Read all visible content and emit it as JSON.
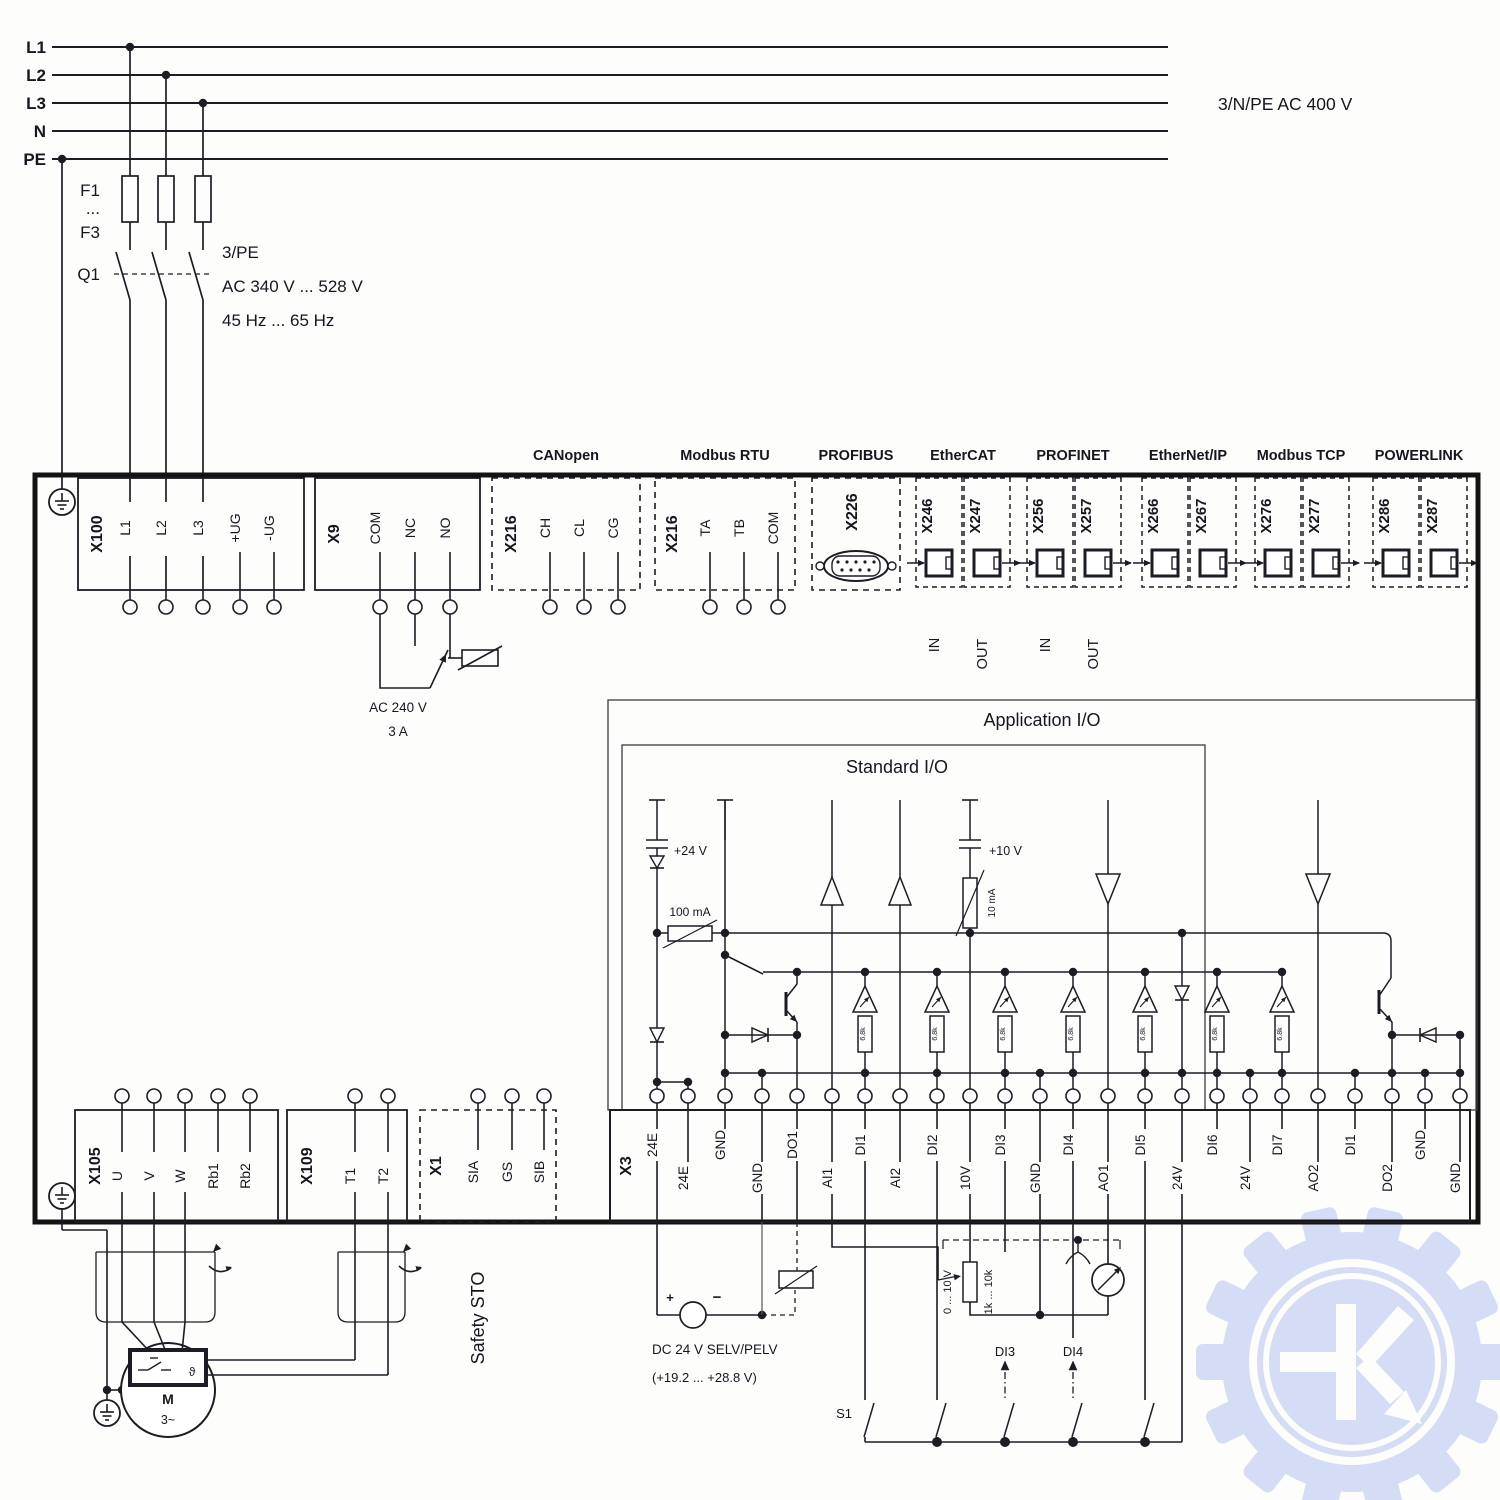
{
  "power": {
    "line_labels": [
      "L1",
      "L2",
      "L3",
      "N",
      "PE"
    ],
    "supply_label": "3/N/PE AC 400 V",
    "fuse_label_top": "F1",
    "fuse_label_mid": "...",
    "fuse_label_bottom": "F3",
    "breaker_label": "Q1",
    "breaker_notes": [
      "3/PE",
      "AC 340 V ... 528 V",
      "45 Hz ... 65 Hz"
    ]
  },
  "relay": {
    "voltage": "AC 240 V",
    "current": "3 A"
  },
  "fieldbus_groups": [
    {
      "name": "CANopen"
    },
    {
      "name": "Modbus RTU"
    },
    {
      "name": "PROFIBUS"
    },
    {
      "name": "EtherCAT"
    },
    {
      "name": "PROFINET"
    },
    {
      "name": "EtherNet/IP"
    },
    {
      "name": "Modbus TCP"
    },
    {
      "name": "POWERLINK"
    }
  ],
  "power_block": {
    "id": "X100",
    "terminals": [
      "L1",
      "L2",
      "L3",
      "+UG",
      "-UG"
    ]
  },
  "relay_block": {
    "id": "X9",
    "terminals": [
      "COM",
      "NC",
      "NO"
    ]
  },
  "can_block": {
    "id": "X216",
    "terminals": [
      "CH",
      "CL",
      "CG"
    ]
  },
  "modbus_block": {
    "id": "X216",
    "terminals": [
      "TA",
      "TB",
      "COM"
    ]
  },
  "profibus_block": {
    "id": "X226"
  },
  "ethernet_ports": [
    {
      "id": "X246",
      "dir": "IN"
    },
    {
      "id": "X247",
      "dir": "OUT"
    },
    {
      "id": "X256",
      "dir": "IN"
    },
    {
      "id": "X257",
      "dir": "OUT"
    },
    {
      "id": "X266",
      "dir": ""
    },
    {
      "id": "X267",
      "dir": ""
    },
    {
      "id": "X276",
      "dir": ""
    },
    {
      "id": "X277",
      "dir": ""
    },
    {
      "id": "X286",
      "dir": ""
    },
    {
      "id": "X287",
      "dir": ""
    }
  ],
  "motor_block": {
    "id": "X105",
    "terminals": [
      "U",
      "V",
      "W",
      "Rb1",
      "Rb2"
    ]
  },
  "temp_block": {
    "id": "X109",
    "terminals": [
      "T1",
      "T2"
    ]
  },
  "sto_block": {
    "id": "X1",
    "terminals": [
      "SIA",
      "GS",
      "SIB"
    ],
    "note": "Safety STO"
  },
  "io_block": {
    "id": "X3",
    "terminals": [
      "24E",
      "24E",
      "GND",
      "GND",
      "DO1",
      "AI1",
      "DI1",
      "AI2",
      "DI2",
      "10V",
      "DI3",
      "GND",
      "DI4",
      "AO1",
      "DI5",
      "24V",
      "DI6",
      "24V",
      "DI7",
      "AO2",
      "DI1",
      "DO2",
      "GND",
      "GND"
    ]
  },
  "io_frames": {
    "application": "Application I/O",
    "standard": "Standard I/O"
  },
  "io_labels": {
    "v24": "+24 V",
    "v10": "+10 V",
    "fuse": "100 mA",
    "current_limit": "10 mA",
    "di_resistor": "6.8k"
  },
  "external": {
    "psu_title": "DC 24 V SELV/PELV",
    "psu_range": "(+19.2 ... +28.8 V)",
    "psu_plus": "+",
    "psu_minus": "−",
    "switch_label": "S1",
    "di3_label": "DI3",
    "di4_label": "DI4",
    "pot_range": "0 ... 10 V",
    "pot_resistance": "1k ... 10k"
  },
  "motor": {
    "symbol": "M",
    "phases": "3~",
    "thermal": "ϑ"
  }
}
